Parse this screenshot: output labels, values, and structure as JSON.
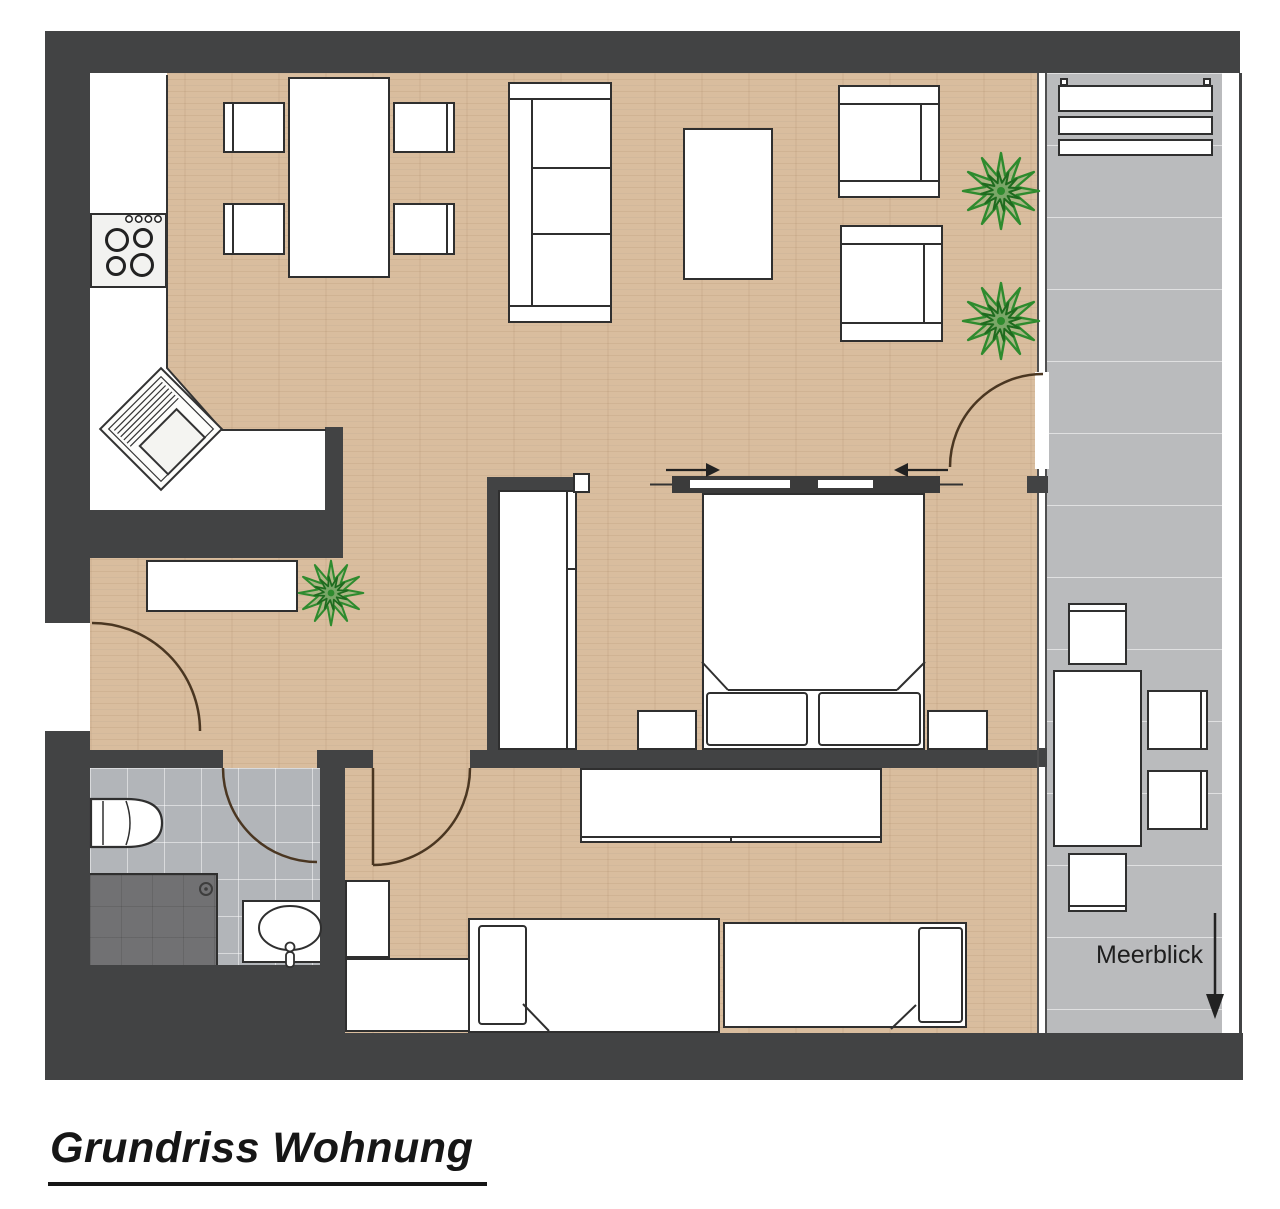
{
  "title": "Grundriss Wohnung",
  "balcony": {
    "view_label": "Meerblick"
  },
  "colors": {
    "wall": "#424344",
    "wood_floor": "#d9bd9e",
    "balcony_tile": "#babbbd",
    "bathroom_tile": "#b2b5b9",
    "shower_tray": "#717173",
    "furniture_fill": "#ffffff",
    "furniture_outline": "#2f2f2f",
    "plant_green": "#2e8b2e",
    "door_arc": "#4a3621",
    "text": "#1c1c1c"
  }
}
